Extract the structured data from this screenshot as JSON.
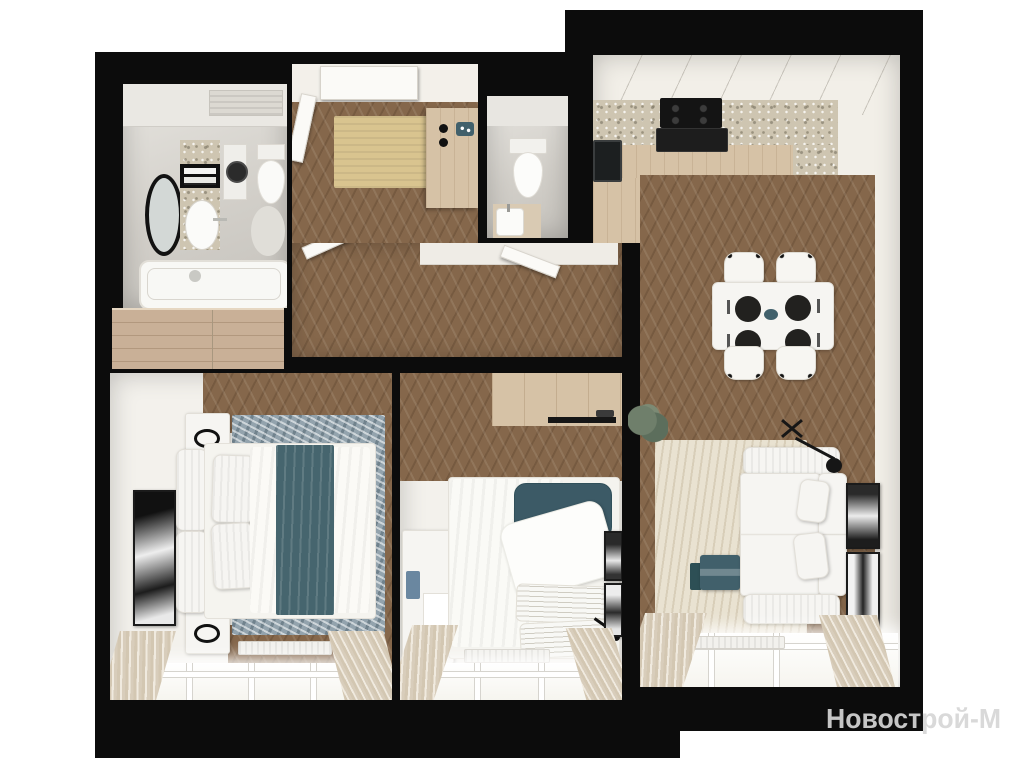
{
  "watermark": {
    "text": "Новострой-М"
  },
  "colors": {
    "wall": "#0c0c0c",
    "background": "#ffffff",
    "wood_floor": "#85674b",
    "cabinet_wood": "#d6c2a6",
    "wardrobe_wood": "#c9b097",
    "terrazzo": "#cec5b1",
    "tile": "#d6d3cd",
    "wall_interior": "#f2efe8",
    "furniture_white": "#f6f5f2",
    "teal_accent": "#41606b",
    "rug_blue": "#93a3ad",
    "rug_cream": "#e9e2d1",
    "curtain_beige": "#d3c7b2",
    "doormat": "#d9c48f",
    "watermark_text": "#d6d6d6"
  },
  "scene": {
    "type": "3d-floor-plan-top-view",
    "rooms": [
      {
        "name": "bathroom",
        "furniture": [
          "bathtub",
          "vanity-sink",
          "oval-mirror",
          "towel-rack",
          "washing-machine",
          "toilet"
        ]
      },
      {
        "name": "entry-hall",
        "furniture": [
          "entrance-door",
          "doormat",
          "console",
          "hall-wardrobe"
        ]
      },
      {
        "name": "wc",
        "furniture": [
          "toilet",
          "small-sink"
        ]
      },
      {
        "name": "corridor",
        "furniture": [
          "open-door-left-bedroom",
          "open-door-middle-bedroom"
        ]
      },
      {
        "name": "kitchen-living-room",
        "furniture": [
          "l-shaped-counter",
          "cooktop-with-hood",
          "black-sink",
          "coffee-machine",
          "dining-table",
          "four-chairs",
          "plant",
          "cream-rug",
          "white-sofa",
          "teal-coffee-table",
          "floor-lamp",
          "two-art-frames",
          "window-with-curtains"
        ]
      },
      {
        "name": "bedroom-left",
        "furniture": [
          "double-bed",
          "teal-throw",
          "two-nightstands",
          "art-frame",
          "blue-rug",
          "radiator",
          "window-with-curtains"
        ]
      },
      {
        "name": "bedroom-middle",
        "furniture": [
          "bed-teal-headboard",
          "striped-pillows",
          "desk",
          "teal-desk-chair",
          "sliding-wardrobe",
          "two-art-frames",
          "radiator",
          "window-with-curtains"
        ]
      }
    ]
  }
}
